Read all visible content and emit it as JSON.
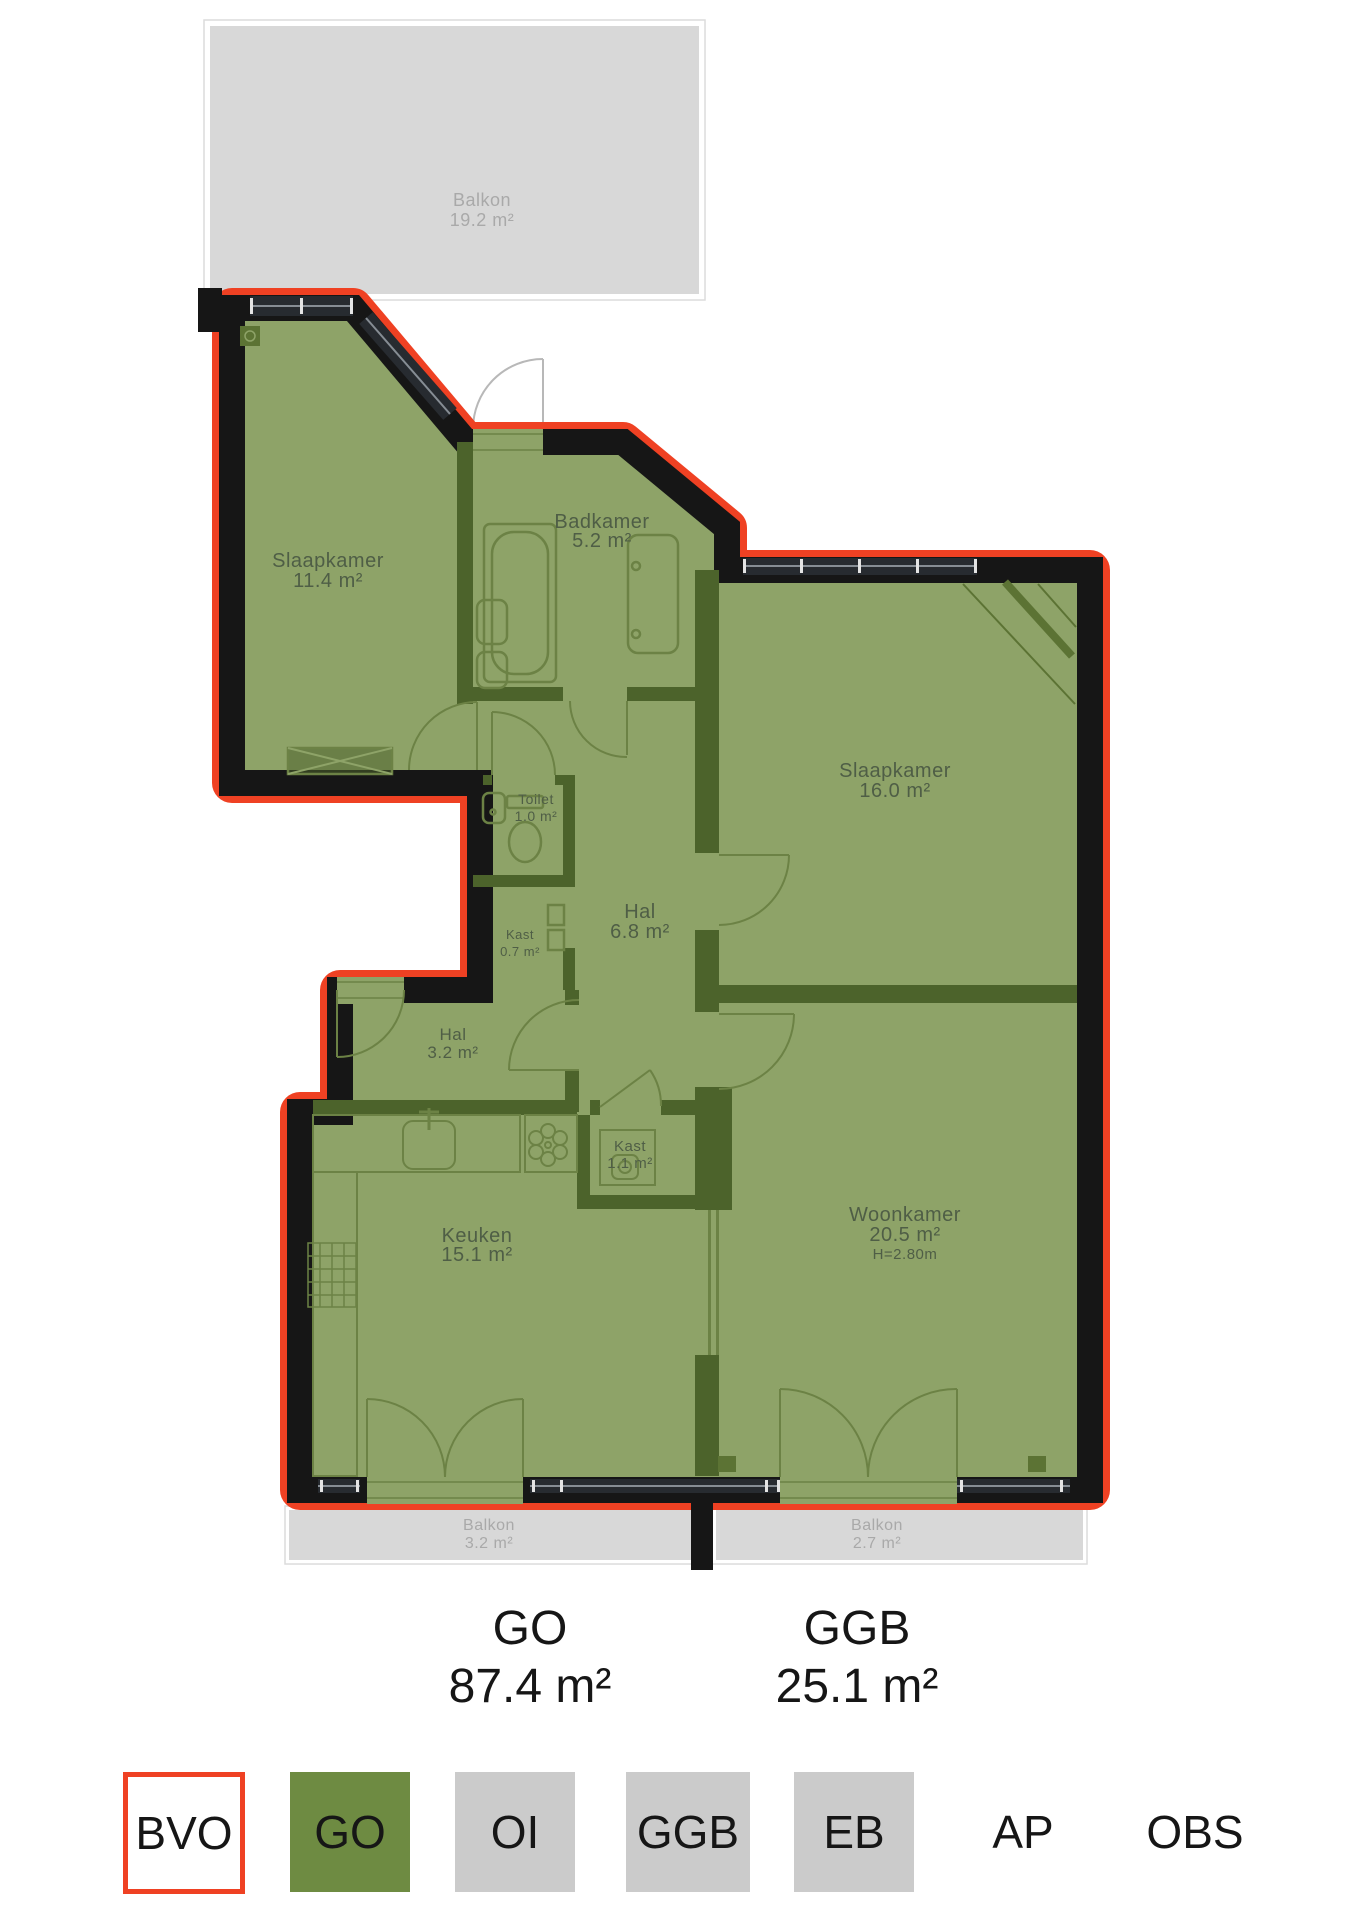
{
  "plan": {
    "rooms": {
      "balkon_boven": {
        "name": "Balkon",
        "area": "19.2 m²"
      },
      "slaapkamer_1": {
        "name": "Slaapkamer",
        "area": "11.4 m²"
      },
      "badkamer": {
        "name": "Badkamer",
        "area": "5.2 m²"
      },
      "toilet": {
        "name": "Toilet",
        "area": "1.0 m²"
      },
      "kast_klein": {
        "name": "Kast",
        "area": "0.7 m²"
      },
      "hal": {
        "name": "Hal",
        "area": "6.8 m²"
      },
      "slaapkamer_2": {
        "name": "Slaapkamer",
        "area": "16.0 m²"
      },
      "hal_2": {
        "name": "Hal",
        "area": "3.2 m²"
      },
      "kast_groot": {
        "name": "Kast",
        "area": "1.1 m²"
      },
      "keuken": {
        "name": "Keuken",
        "area": "15.1 m²"
      },
      "woonkamer": {
        "name": "Woonkamer",
        "area": "20.5 m²",
        "height": "H=2.80m"
      },
      "balkon_links": {
        "name": "Balkon",
        "area": "3.2 m²"
      },
      "balkon_rechts": {
        "name": "Balkon",
        "area": "2.7 m²"
      }
    }
  },
  "totals": {
    "go": {
      "code": "GO",
      "area": "87.4 m²"
    },
    "ggb": {
      "code": "GGB",
      "area": "25.1 m²"
    }
  },
  "legend": {
    "bvo": {
      "code": "BVO"
    },
    "go": {
      "code": "GO"
    },
    "oi": {
      "code": "OI"
    },
    "ggb": {
      "code": "GGB"
    },
    "eb": {
      "code": "EB"
    },
    "ap": {
      "code": "AP"
    },
    "obs": {
      "code": "OBS"
    }
  },
  "colors": {
    "bvo_red": "#ef4123",
    "go_green": "#6e8b42",
    "plan_green": "#8ea368",
    "interior_wall_green": "#4c632b",
    "wall_black": "#161616",
    "balcony_gray": "#d8d8d8",
    "legend_gray": "#cbcbcb"
  }
}
